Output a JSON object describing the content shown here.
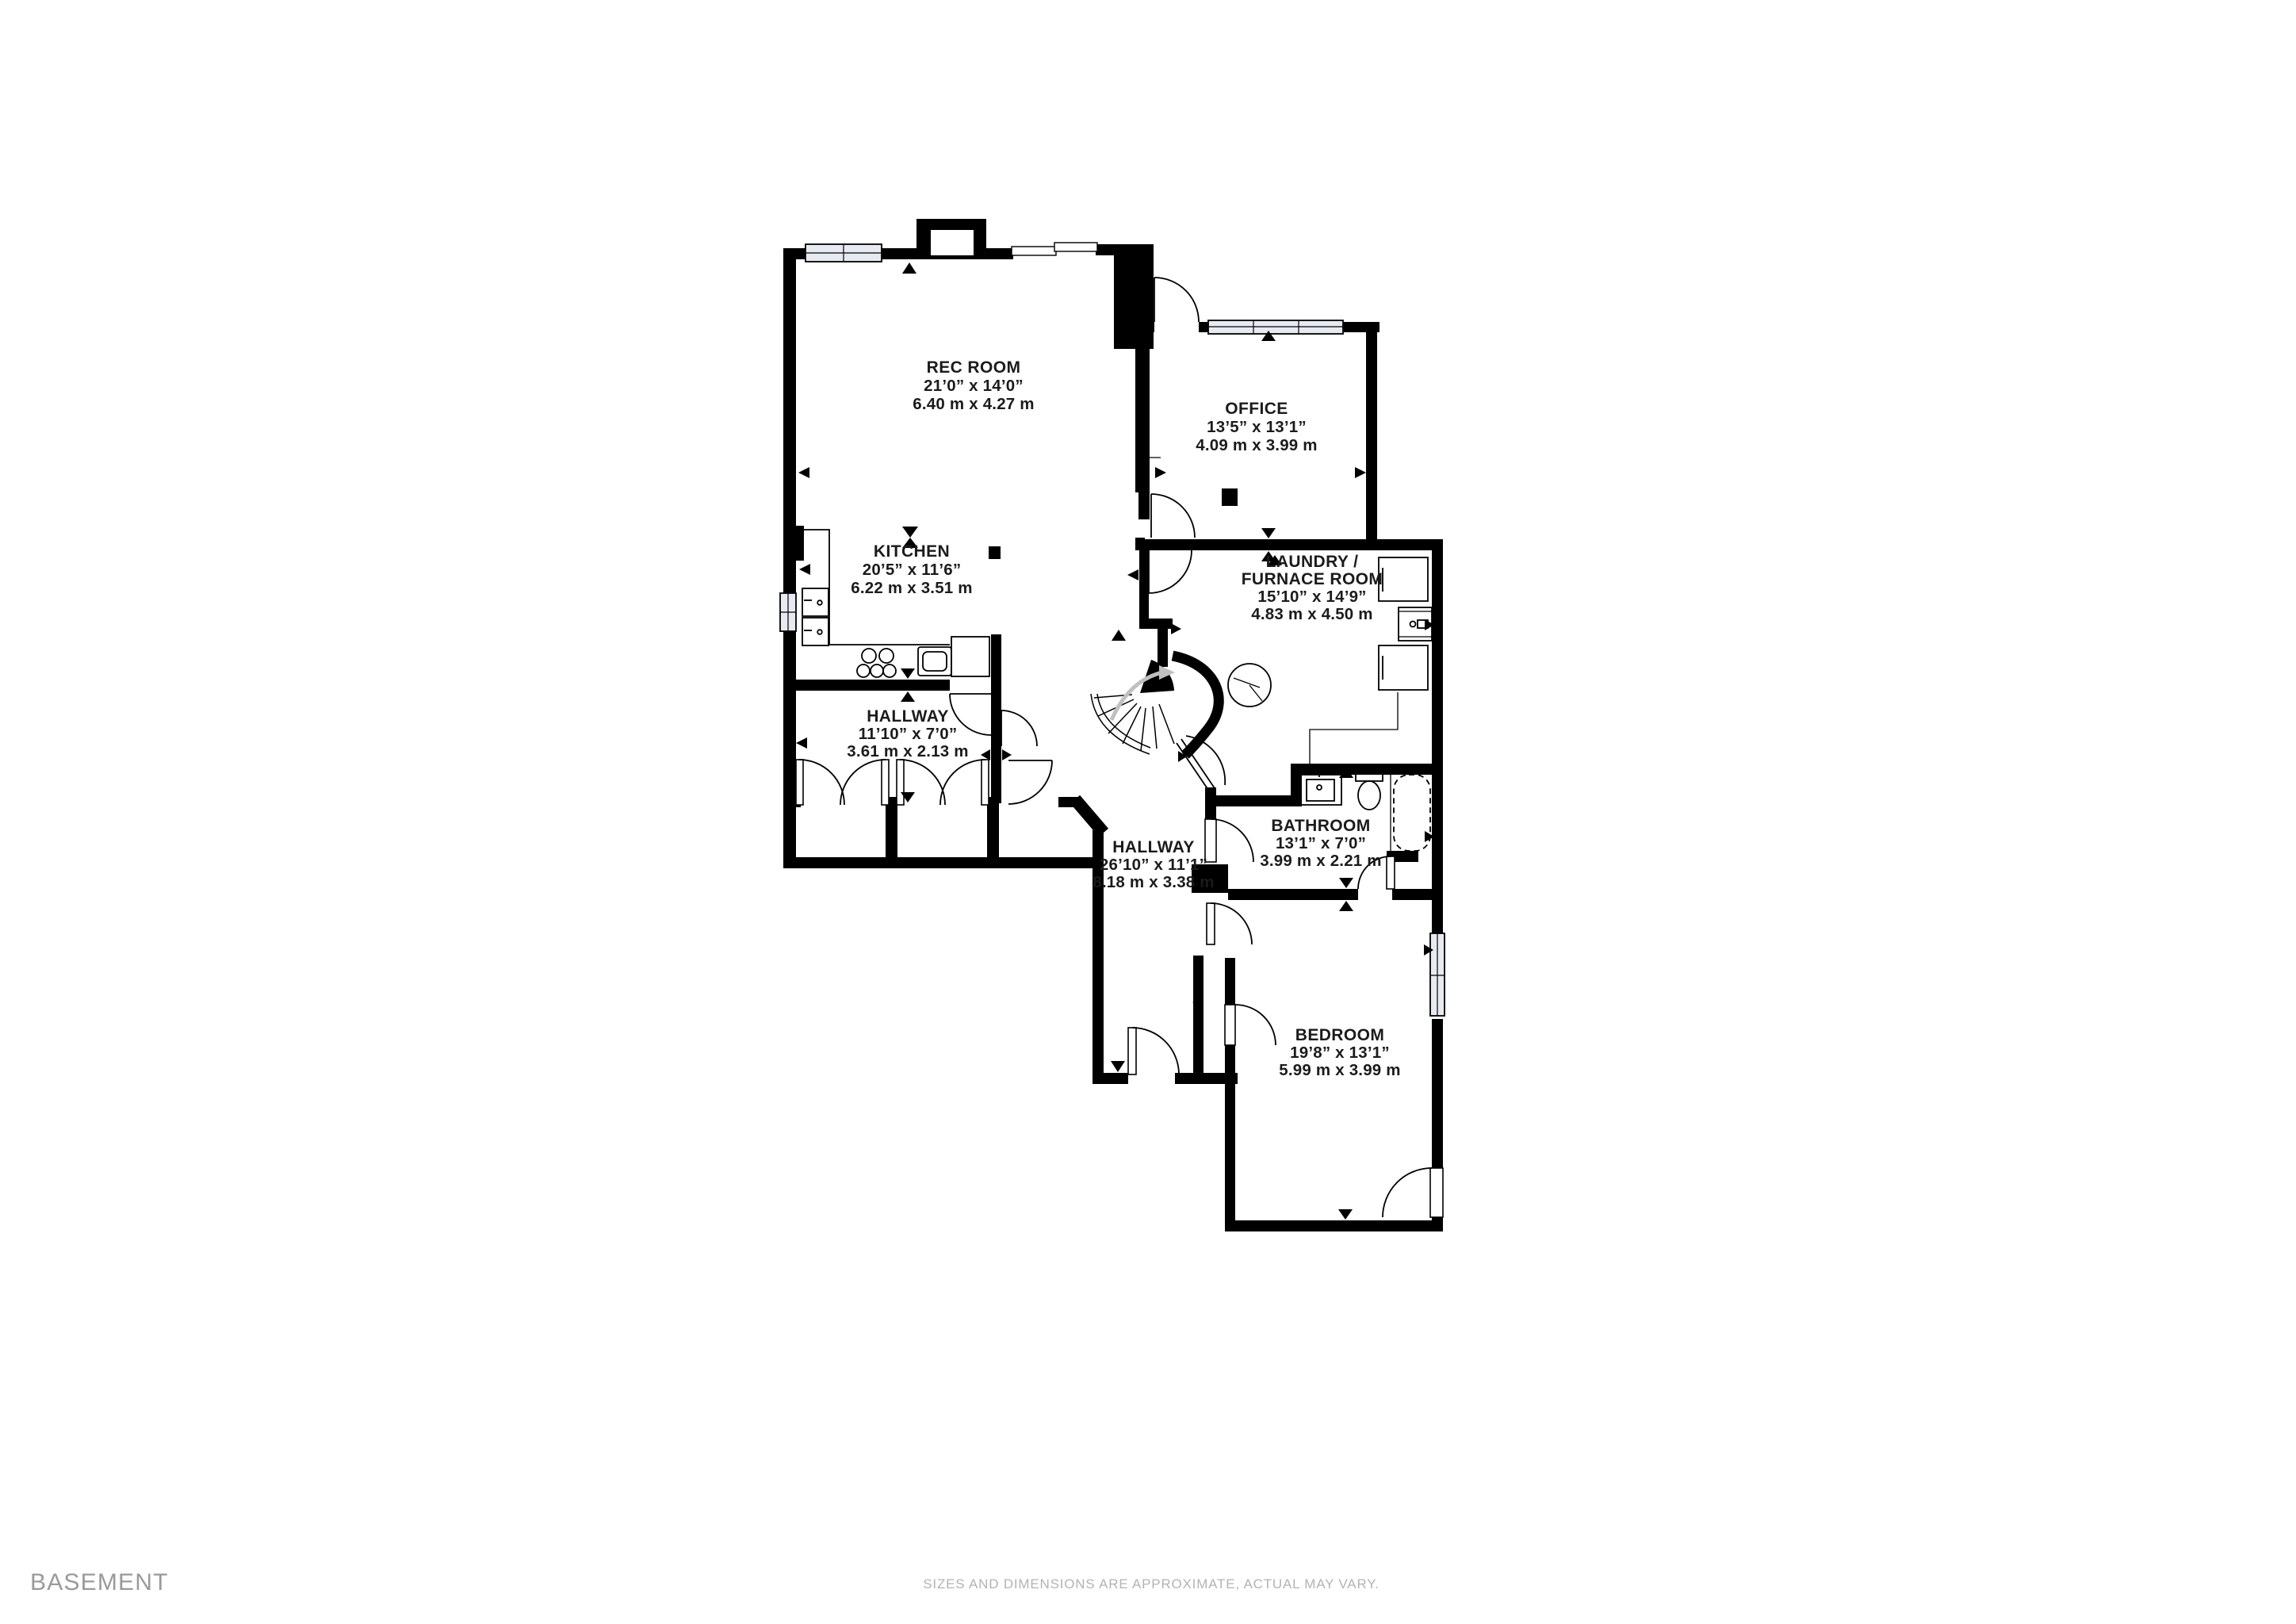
{
  "floor": {
    "name": "BASEMENT"
  },
  "disclaimer": "SIZES AND DIMENSIONS ARE APPROXIMATE, ACTUAL MAY VARY.",
  "colors": {
    "wall": "#000000",
    "window_fill": "#e8eaf2",
    "label_text": "#1b1b1b",
    "floor_label_text": "#9a9a9a",
    "disclaimer_text": "#b3b3b3",
    "stair_arrow": "#c0c0c0"
  },
  "icons": {
    "dimension-arrow-icon": "triangle pointing to wall",
    "ceiling-light-icon": "black square",
    "fan-symbol-icon": "black bowtie",
    "furnace-icon": "circle with blades",
    "stair-direction-icon": "gray curved arrow"
  },
  "rooms": {
    "rec_room": {
      "name": "REC ROOM",
      "imperial": "21’0” x 14’0”",
      "metric": "6.40 m x 4.27 m"
    },
    "office": {
      "name": "OFFICE",
      "imperial": "13’5” x 13’1”",
      "metric": "4.09 m x 3.99 m"
    },
    "kitchen": {
      "name": "KITCHEN",
      "imperial": "20’5” x 11’6”",
      "metric": "6.22 m x 3.51 m"
    },
    "laundry": {
      "name_line1": "LAUNDRY /",
      "name_line2": "FURNACE ROOM",
      "imperial": "15’10” x 14’9”",
      "metric": "4.83 m x 4.50 m"
    },
    "hallway_upper": {
      "name": "HALLWAY",
      "imperial": "11’10” x 7’0”",
      "metric": "3.61 m x 2.13 m"
    },
    "hallway_lower": {
      "name": "HALLWAY",
      "imperial": "26’10” x 11’1”",
      "metric": "8.18 m x 3.38 m"
    },
    "bathroom": {
      "name": "BATHROOM",
      "imperial": "13’1” x 7’0”",
      "metric": "3.99 m x 2.21 m"
    },
    "bedroom": {
      "name": "BEDROOM",
      "imperial": "19’8” x 13’1”",
      "metric": "5.99 m x 3.99 m"
    }
  }
}
